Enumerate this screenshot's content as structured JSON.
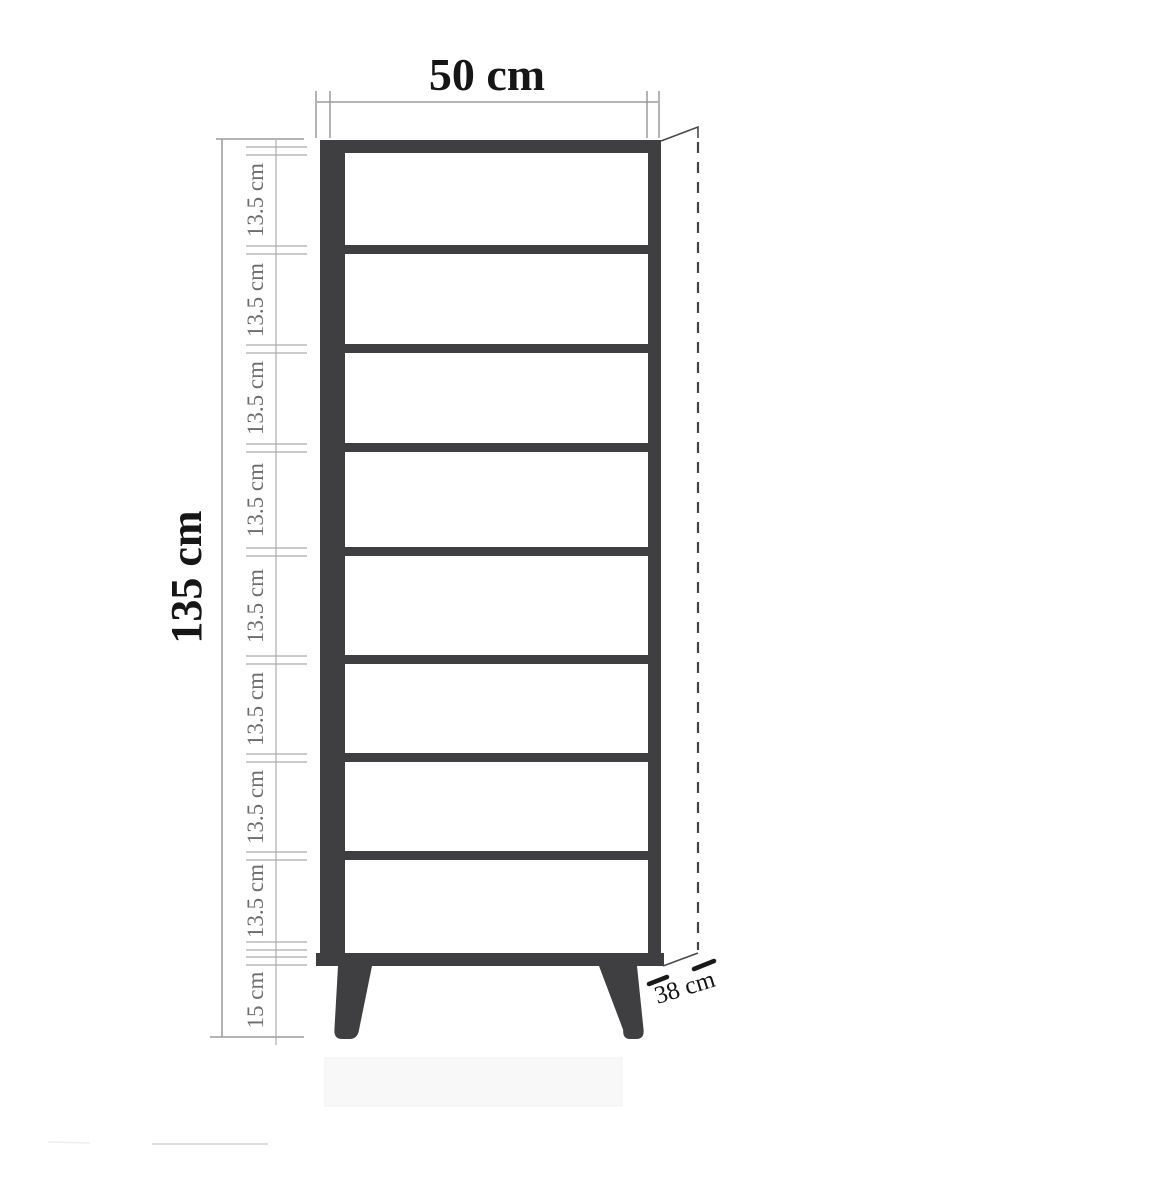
{
  "diagram": {
    "subject": "shelf-unit-dimension-drawing",
    "labels": {
      "width": "50 cm",
      "height": "135 cm",
      "depth": "38 cm",
      "leg_height": "15 cm"
    },
    "segment_labels": [
      "13.5 cm",
      "13.5 cm",
      "13.5 cm",
      "13.5 cm",
      "13.5 cm",
      "13.5 cm",
      "13.5 cm",
      "13.5 cm"
    ],
    "counts": {
      "compartments": 8,
      "shelves": 7,
      "legs": 2
    },
    "colors": {
      "background": "#ffffff",
      "frame": "#3f3f41",
      "dimension_line": "#9b9b9b",
      "segment_text": "#6d6d6d",
      "main_text": "#161616",
      "dashed_depth_line": "#434345",
      "shadow_box": "#f8f8f8"
    }
  }
}
